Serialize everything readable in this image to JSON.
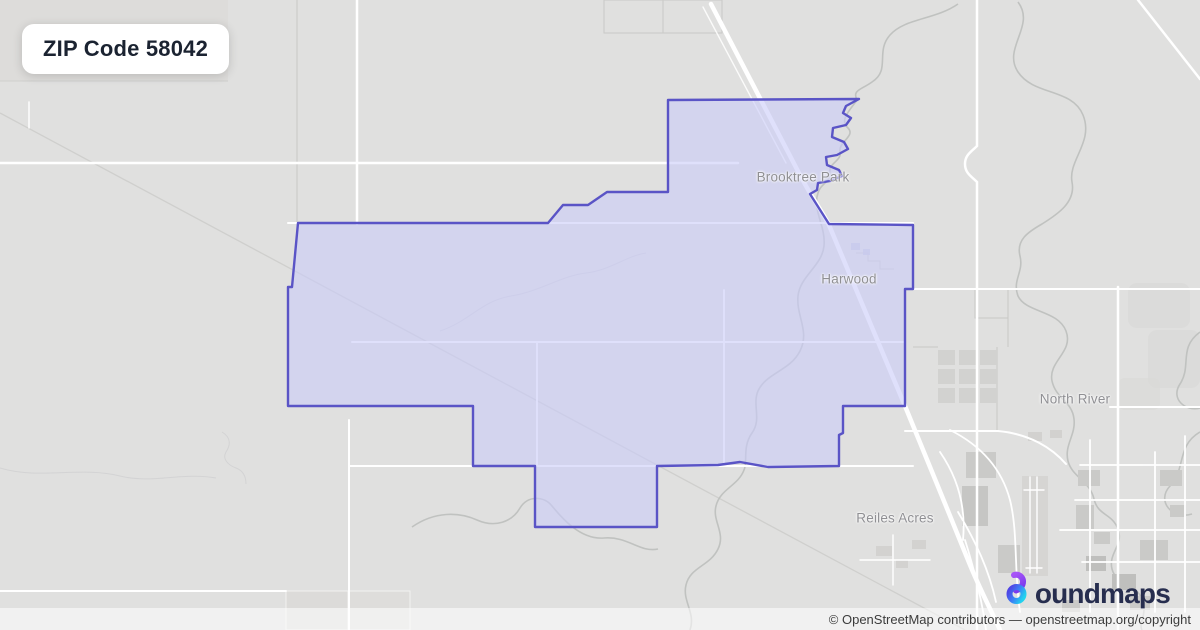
{
  "badge": {
    "label": "ZIP Code 58042"
  },
  "map": {
    "zip_code": "58042",
    "labels": [
      {
        "id": "brooktree-park",
        "text": "Brooktree Park"
      },
      {
        "id": "harwood",
        "text": "Harwood"
      },
      {
        "id": "north-river",
        "text": "North River"
      },
      {
        "id": "reiles-acres",
        "text": "Reiles Acres"
      }
    ]
  },
  "logo": {
    "brand": "boundmaps",
    "text_after_icon": "oundmaps"
  },
  "attribution": {
    "text": "© OpenStreetMap contributors — openstreetmap.org/copyright"
  },
  "theme": {
    "map-bg": "#e0e0df",
    "road-color": "#ffffff",
    "boundary-color": "#5a54c6",
    "boundary-fill": "rgba(202,204,248,0.6)",
    "badge-text-color": "#1b2331",
    "label-color": "#8f8f93",
    "logo-text-color": "#272e4f",
    "logo-purple": "#8b5cf6",
    "logo-indigo": "#4f46e5",
    "logo-cyan": "#22d3ee",
    "attribution-color": "#3c3c3c"
  }
}
